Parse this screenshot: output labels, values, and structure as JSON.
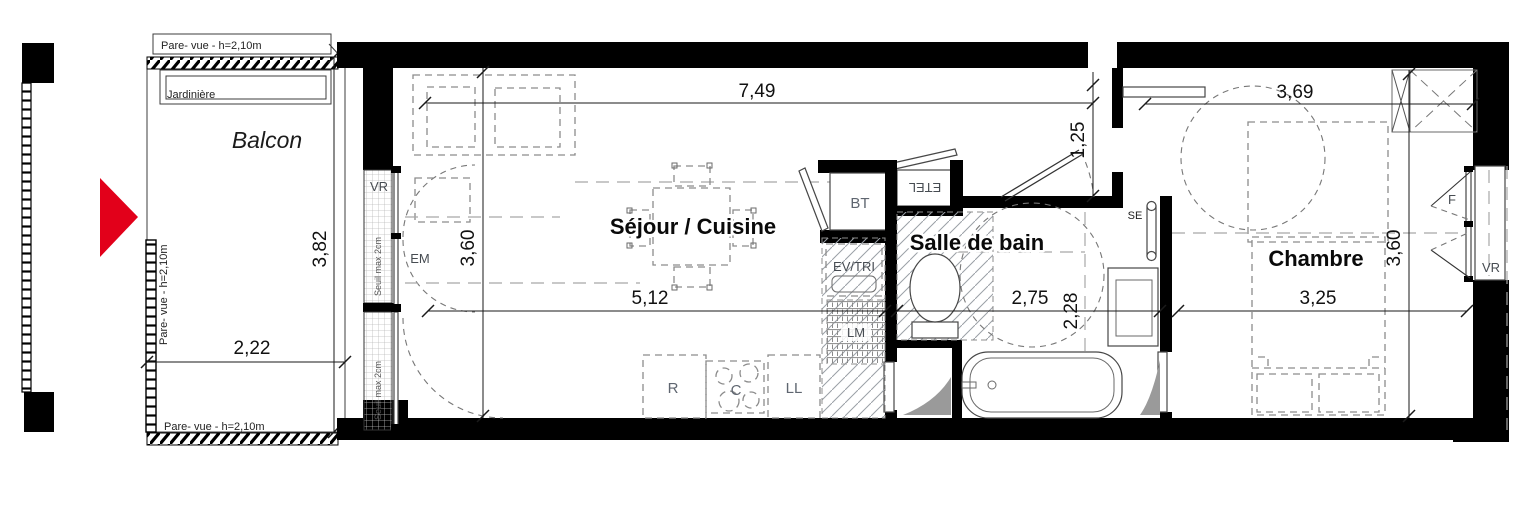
{
  "plan": {
    "type": "apartment-floor-plan",
    "colors": {
      "wall": "#000000",
      "arrow_red": "#e2001a",
      "dashed_gray": "#8c8c8c",
      "text": "#111111"
    },
    "rooms": {
      "balcon": "Balcon",
      "sejour": "Séjour / Cuisine",
      "bain": "Salle de bain",
      "chambre": "Chambre"
    },
    "dims": {
      "sejour_top": "7,49",
      "sejour_w": "5,12",
      "sejour_h": "3,60",
      "balcon_w": "2,22",
      "balcon_h": "3,82",
      "entry": "1,25",
      "bain_w": "2,75",
      "bain_h": "2,28",
      "chambre_top": "3,69",
      "chambre_w": "3,25",
      "chambre_h": "3,60"
    },
    "labels": {
      "pare_vue_top": "Pare- vue - h=2,10m",
      "pare_vue_left": "Pare- vue - h=2,10m",
      "pare_vue_bottom": "Pare- vue - h=2,10m",
      "jardiniere": "Jardinière",
      "seuil_upper": "Seuil max 2cm",
      "seuil_lower": "Seuil max 2cm",
      "vr_left": "VR",
      "em": "EM",
      "bt": "BT",
      "etel": "ETEL",
      "ev_tri": "EV/TRI",
      "lm": "LM",
      "se": "SE",
      "r": "R",
      "c": "C",
      "ll": "LL",
      "f": "F",
      "vr_right": "VR"
    }
  }
}
